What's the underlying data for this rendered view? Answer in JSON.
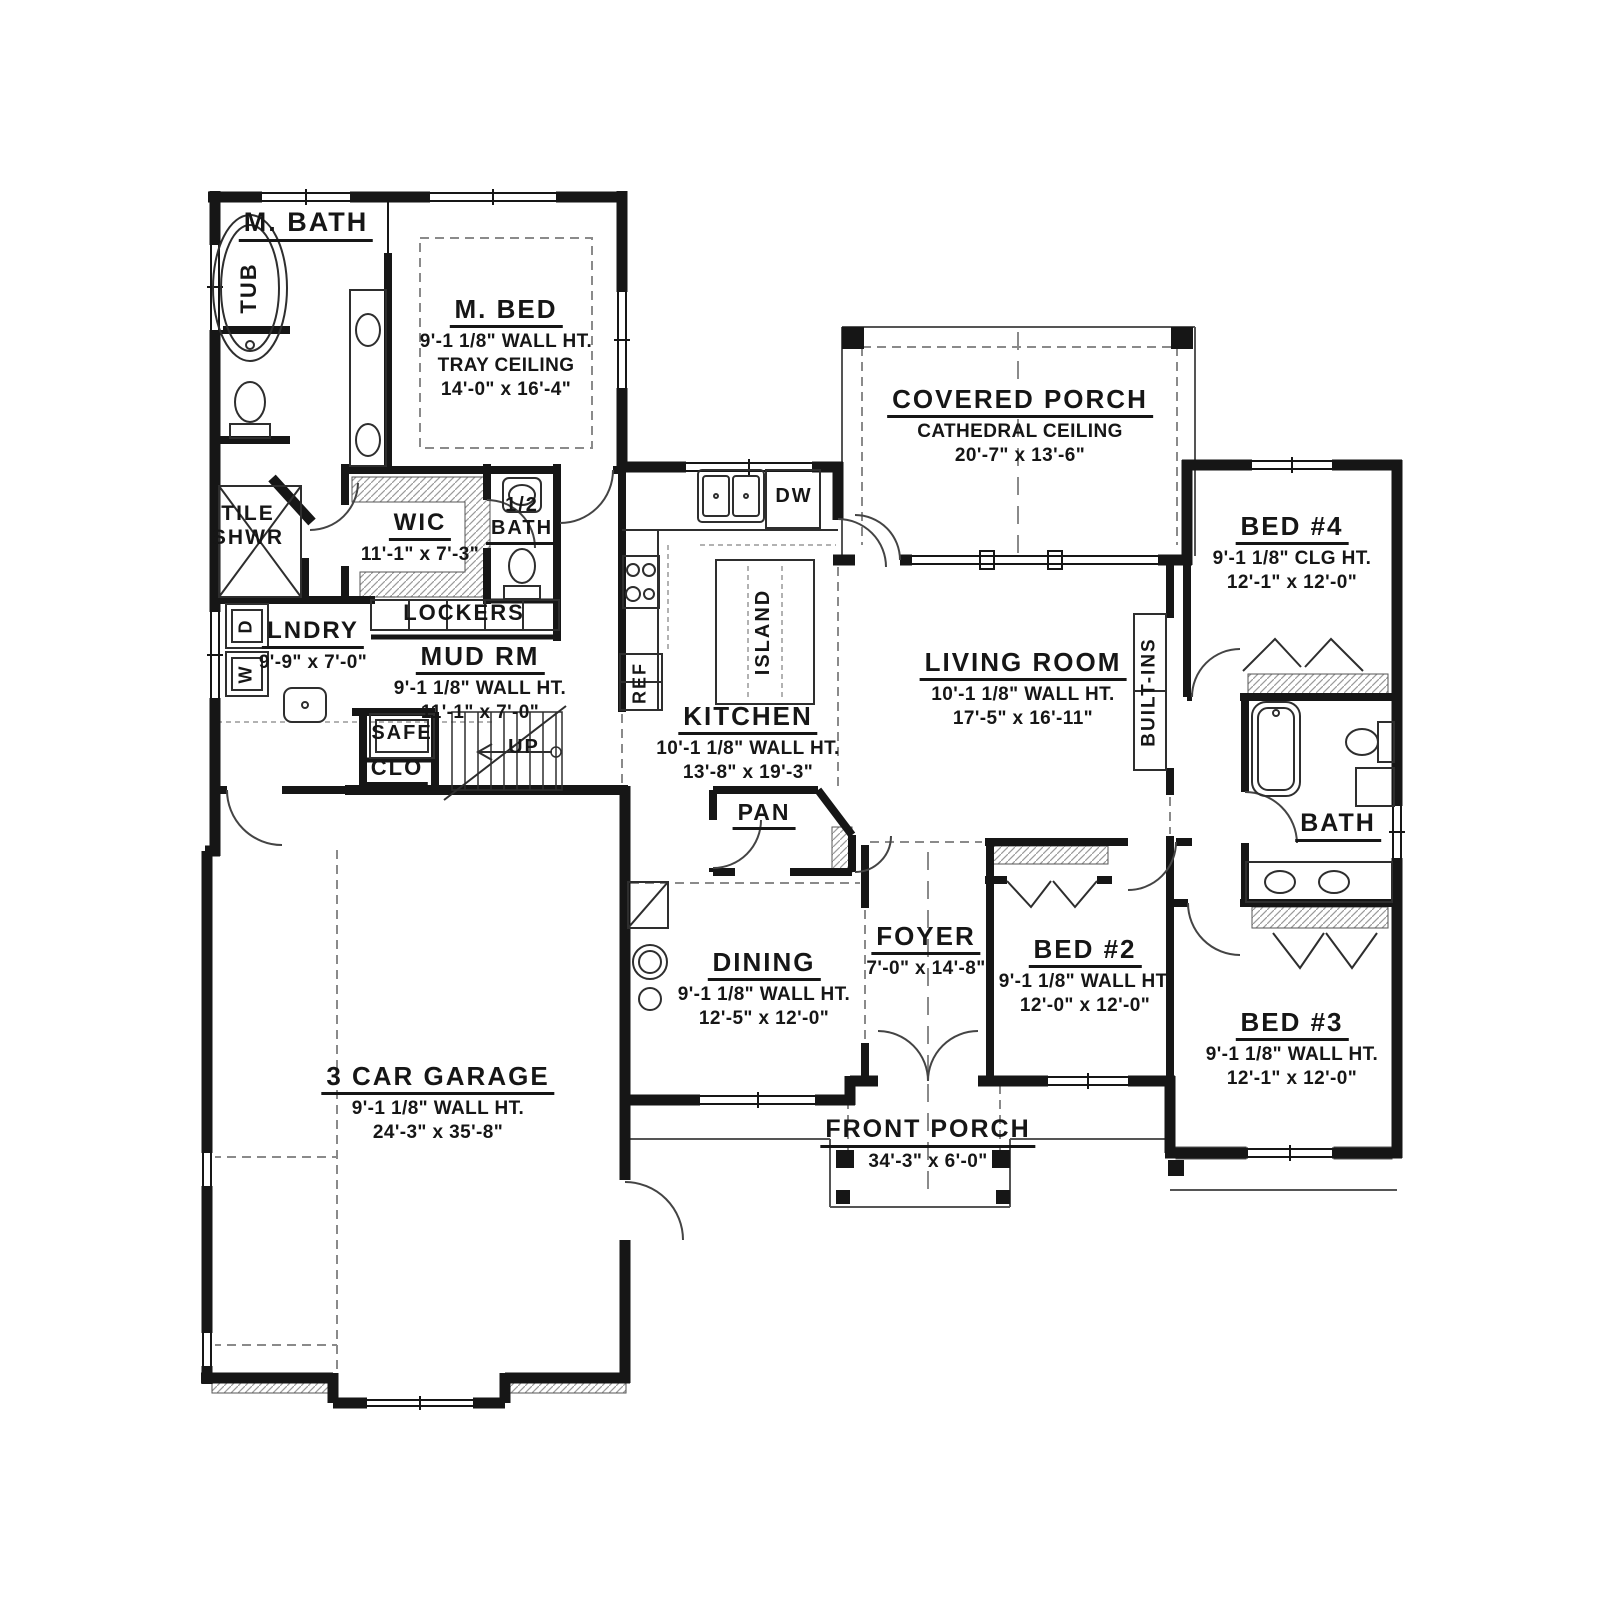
{
  "plan_title": "First floor plan",
  "colors": {
    "wall": "#161616",
    "fixture_line": "#2e2e2e",
    "thin_line": "#555555",
    "dash_line": "#8a8a8a",
    "hatch": "#9a9a9a",
    "background": "#ffffff"
  },
  "labels": [
    {
      "id": "m-bath",
      "text": "M. BATH",
      "x": 306,
      "y": 208,
      "size": 27,
      "u": true,
      "lines": []
    },
    {
      "id": "m-bed",
      "text": "M. BED",
      "x": 506,
      "y": 295,
      "size": 26,
      "u": true,
      "lines": [
        "9'-1 1/8\" WALL HT.",
        "TRAY CEILING",
        "14'-0\" x 16'-4\""
      ]
    },
    {
      "id": "covered-porch",
      "text": "COVERED PORCH",
      "x": 1020,
      "y": 385,
      "size": 26,
      "u": true,
      "lines": [
        "CATHEDRAL CEILING",
        "20'-7\" x 13'-6\""
      ]
    },
    {
      "id": "bed4",
      "text": "BED #4",
      "x": 1292,
      "y": 512,
      "size": 26,
      "u": true,
      "lines": [
        "9'-1 1/8\" CLG HT.",
        "12'-1\" x 12'-0\""
      ]
    },
    {
      "id": "wic",
      "text": "WIC",
      "x": 420,
      "y": 510,
      "size": 24,
      "u": true,
      "lines": [
        "11'-1\" x 7'-3\""
      ]
    },
    {
      "id": "half-bath-num",
      "text": "1/2",
      "x": 522,
      "y": 495,
      "size": 20,
      "u": false,
      "lines": []
    },
    {
      "id": "half-bath",
      "text": "BATH",
      "x": 522,
      "y": 518,
      "size": 20,
      "u": true,
      "lines": []
    },
    {
      "id": "tile",
      "text": "TILE",
      "x": 248,
      "y": 503,
      "size": 21,
      "u": false,
      "lines": []
    },
    {
      "id": "shwr",
      "text": "SHWR",
      "x": 248,
      "y": 527,
      "size": 21,
      "u": false,
      "lines": []
    },
    {
      "id": "lockers",
      "text": "LOCKERS",
      "x": 464,
      "y": 601,
      "size": 22,
      "u": false,
      "lines": []
    },
    {
      "id": "lndry",
      "text": "LNDRY",
      "x": 313,
      "y": 618,
      "size": 24,
      "u": true,
      "lines": [
        "9'-9\" x 7'-0\""
      ]
    },
    {
      "id": "mud-rm",
      "text": "MUD RM",
      "x": 480,
      "y": 642,
      "size": 26,
      "u": true,
      "lines": [
        "9'-1 1/8\" WALL HT.",
        "11'-1\" x 7'-0\""
      ]
    },
    {
      "id": "safe",
      "text": "SAFE",
      "x": 402,
      "y": 723,
      "size": 20,
      "u": false,
      "lines": []
    },
    {
      "id": "clo",
      "text": "CLO",
      "x": 397,
      "y": 756,
      "size": 22,
      "u": true,
      "lines": []
    },
    {
      "id": "up",
      "text": "UP",
      "x": 524,
      "y": 737,
      "size": 20,
      "u": false,
      "lines": []
    },
    {
      "id": "kitchen",
      "text": "KITCHEN",
      "x": 748,
      "y": 702,
      "size": 26,
      "u": true,
      "lines": [
        "10'-1 1/8\" WALL HT.",
        "13'-8\" x 19'-3\""
      ]
    },
    {
      "id": "dw",
      "text": "DW",
      "x": 794,
      "y": 486,
      "size": 20,
      "u": false,
      "lines": []
    },
    {
      "id": "living-room",
      "text": "LIVING ROOM",
      "x": 1023,
      "y": 648,
      "size": 26,
      "u": true,
      "lines": [
        "10'-1 1/8\" WALL HT.",
        "17'-5\" x 16'-11\""
      ]
    },
    {
      "id": "pan",
      "text": "PAN",
      "x": 764,
      "y": 800,
      "size": 23,
      "u": true,
      "lines": []
    },
    {
      "id": "dining",
      "text": "DINING",
      "x": 764,
      "y": 948,
      "size": 26,
      "u": true,
      "lines": [
        "9'-1 1/8\" WALL HT.",
        "12'-5\" x 12'-0\""
      ]
    },
    {
      "id": "foyer",
      "text": "FOYER",
      "x": 926,
      "y": 922,
      "size": 26,
      "u": true,
      "lines": [
        "7'-0\" x 14'-8\""
      ]
    },
    {
      "id": "bed2",
      "text": "BED #2",
      "x": 1085,
      "y": 935,
      "size": 26,
      "u": true,
      "lines": [
        "9'-1 1/8\" WALL HT.",
        "12'-0\" x 12'-0\""
      ]
    },
    {
      "id": "bath",
      "text": "BATH",
      "x": 1338,
      "y": 810,
      "size": 25,
      "u": true,
      "lines": []
    },
    {
      "id": "bed3",
      "text": "BED #3",
      "x": 1292,
      "y": 1008,
      "size": 26,
      "u": true,
      "lines": [
        "9'-1 1/8\" WALL HT.",
        "12'-1\" x 12'-0\""
      ]
    },
    {
      "id": "garage",
      "text": "3 CAR GARAGE",
      "x": 438,
      "y": 1062,
      "size": 26,
      "u": true,
      "lines": [
        "9'-1 1/8\" WALL HT.",
        "24'-3\" x 35'-8\""
      ]
    },
    {
      "id": "front-porch",
      "text": "FRONT PORCH",
      "x": 928,
      "y": 1116,
      "size": 25,
      "u": true,
      "lines": [
        "34'-3\" x 6'-0\""
      ]
    },
    {
      "id": "tub",
      "text": "TUB",
      "x": 250,
      "y": 288,
      "size": 22,
      "u": false,
      "rot": true,
      "lines": []
    },
    {
      "id": "island",
      "text": "ISLAND",
      "x": 765,
      "y": 632,
      "size": 20,
      "u": false,
      "rot": true,
      "lines": []
    },
    {
      "id": "ref",
      "text": "REF",
      "x": 641,
      "y": 683,
      "size": 18,
      "u": false,
      "rot": true,
      "lines": []
    },
    {
      "id": "built-ins",
      "text": "BUILT-INS",
      "x": 1151,
      "y": 692,
      "size": 19,
      "u": false,
      "rot": true,
      "lines": []
    },
    {
      "id": "dryer",
      "text": "D",
      "x": 247,
      "y": 626,
      "size": 18,
      "u": false,
      "rot": true,
      "lines": []
    },
    {
      "id": "washer",
      "text": "W",
      "x": 247,
      "y": 674,
      "size": 18,
      "u": false,
      "rot": true,
      "lines": []
    }
  ]
}
